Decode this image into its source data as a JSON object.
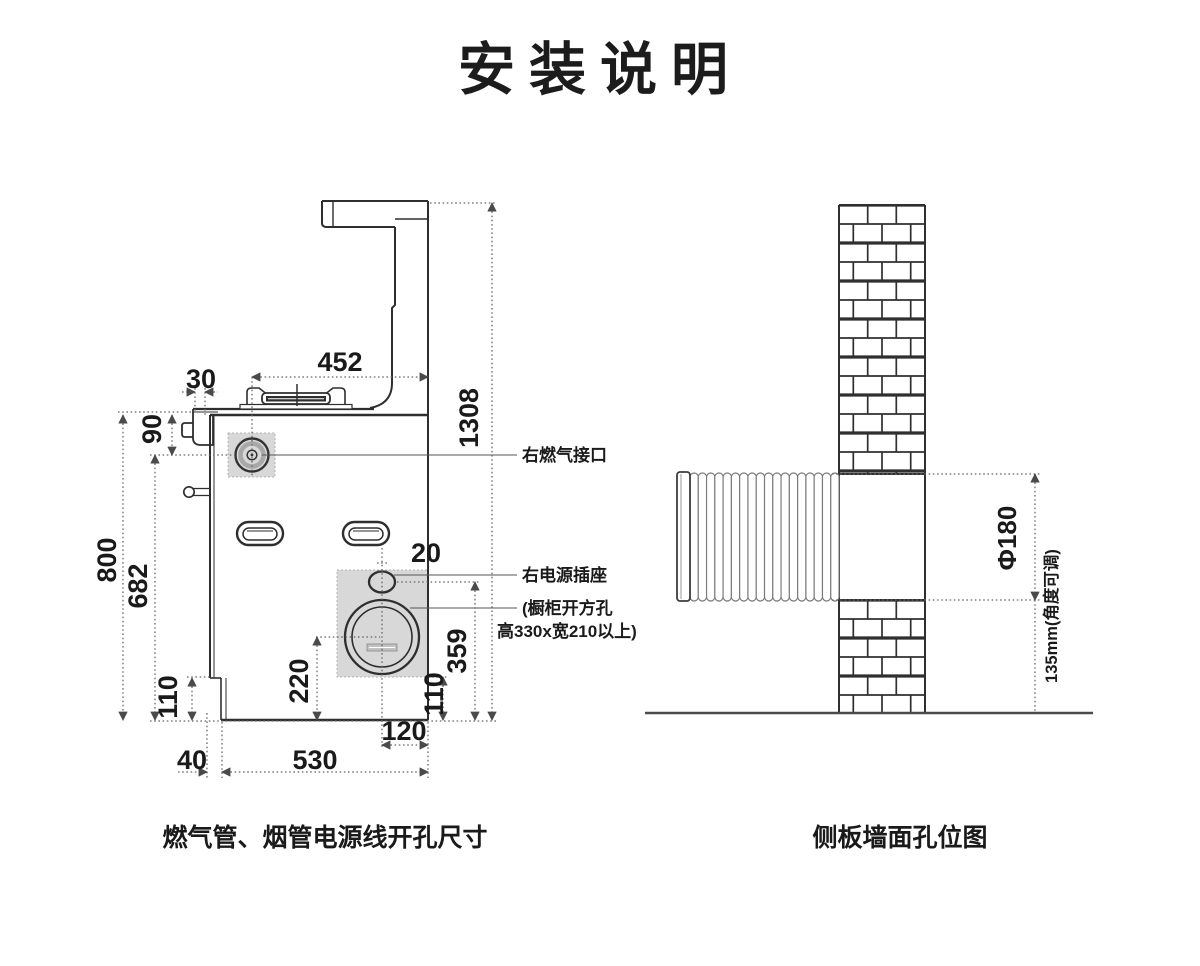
{
  "title": "安装说明",
  "colors": {
    "line": "#2e2e2e",
    "dim": "#666666",
    "panel_fill": "#d8d8d8"
  },
  "left_diagram": {
    "caption": "燃气管、烟管电源线开孔尺寸",
    "callouts": {
      "gas_port": "右燃气接口",
      "power_socket": "右电源插座",
      "cabinet_hole_line1": "(橱柜开方孔",
      "cabinet_hole_line2": "高330x宽210以上)"
    },
    "dimensions": {
      "top_width": "452",
      "left_offset": "30",
      "total_height": "1308",
      "gas_port_drop": "90",
      "body_height": "800",
      "gas_port_to_bottom": "682",
      "base_step_height_left": "110",
      "hole_center_to_bottom": "220",
      "socket_offset": "20",
      "socket_to_bottom": "359",
      "hole_bottom_to_base": "110",
      "hole_center_to_edge": "120",
      "base_inset": "40",
      "bottom_width": "530"
    }
  },
  "right_diagram": {
    "caption": "侧板墙面孔位图",
    "dimensions": {
      "hole_diameter": "Φ180",
      "bottom_clearance": "135mm(角度可调)"
    }
  }
}
